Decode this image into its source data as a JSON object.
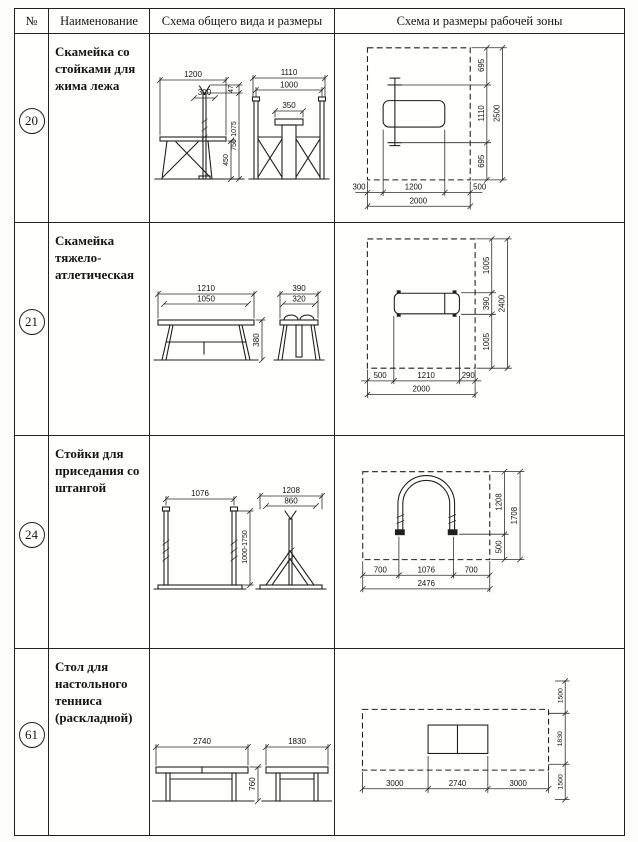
{
  "header": {
    "col_num": "№",
    "col_name": "Наименование",
    "col_general": "Схема общего вида и размеры",
    "col_zone": "Схема и размеры рабочей зоны"
  },
  "rows": [
    {
      "num": "20",
      "name": "Скамейка со стойками для жима лежа",
      "general": {
        "bench_len": "1200",
        "rack_w": "300",
        "fork_h": "47",
        "rack_h": "750-1075",
        "bench_h": "450",
        "front_w": "1110",
        "front_inner_w": "1000",
        "seat_w": "350"
      },
      "zone": {
        "top": "695",
        "mid": "1110",
        "bottom": "695",
        "total_v": "2500",
        "left": "300",
        "center": "1200",
        "right": "500",
        "total_h": "2000"
      }
    },
    {
      "num": "21",
      "name": "Скамейка тяжело-атлетическая",
      "general": {
        "len_outer": "1210",
        "len_inner": "1050",
        "height": "380",
        "end_outer": "390",
        "end_inner": "320"
      },
      "zone": {
        "top": "1005",
        "mid": "390",
        "bottom": "1005",
        "total_v": "2400",
        "left": "500",
        "center": "1210",
        "right": "290",
        "total_h": "2000"
      }
    },
    {
      "num": "24",
      "name": "Стойки для приседания со штангой",
      "general": {
        "span": "1076",
        "height": "1000-1750",
        "side_outer": "1208",
        "side_inner": "860"
      },
      "zone": {
        "top": "1208",
        "bottom": "500",
        "total_v": "1708",
        "left": "700",
        "center": "1076",
        "right": "700",
        "total_h": "2476"
      }
    },
    {
      "num": "61",
      "name": "Стол для настольного тенниса (раскладной)",
      "general": {
        "length": "2740",
        "height": "760",
        "width": "1830"
      },
      "zone": {
        "top": "1500",
        "mid": "1830",
        "bottom": "1500",
        "left": "3000",
        "center": "2740",
        "right": "3000"
      }
    }
  ]
}
